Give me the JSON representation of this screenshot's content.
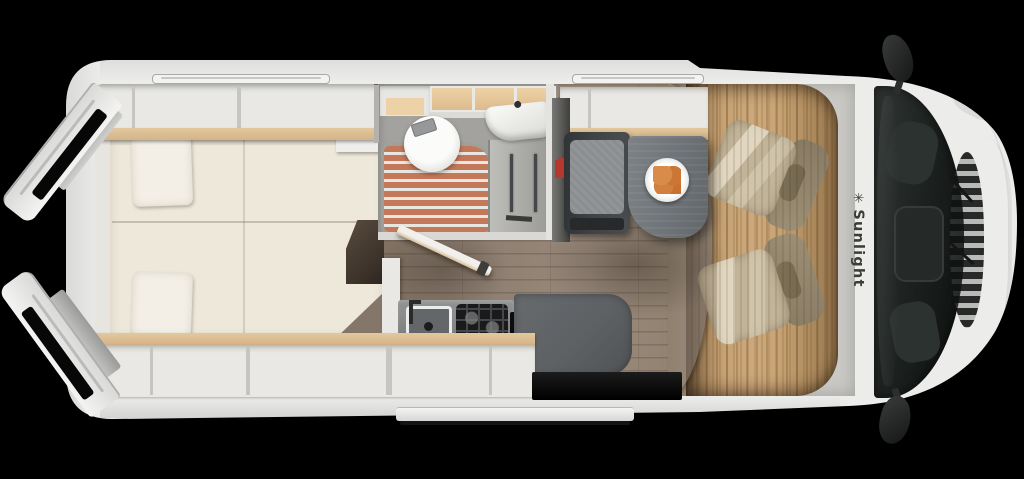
{
  "brand": {
    "name": "Sunlight",
    "logo_glyph": "✳"
  },
  "scene": {
    "description": "Top-down 3D cutaway floor plan render of a Sunlight camper van with open rear doors, rear bed, bathroom, kitchenette, dinette and swiveled cab seats",
    "background_color": "#000000"
  },
  "colors": {
    "bg": "#000000",
    "body-white": "#ececea",
    "interior-grey": "#c9c8c4",
    "bed-cream": "#eee8db",
    "pillow-cream": "#f3efe6",
    "wood-trim": "#e3c89e",
    "bath-cabinet-wood": "#ecd2a6",
    "shower-terracotta": "#c4785a",
    "living-floor-wood": "#8f8073",
    "cab-floor-wood": "#cca87a",
    "counter-grey": "#8a8c8b",
    "table-grey": "#70757a",
    "bench-dark": "#3f4244",
    "mat-grey": "#5d6164",
    "seat-beige": "#c2b499",
    "accent-red": "#b5382e",
    "windshield-dark": "#1a1e1d",
    "brand-text": "#3c3c3a",
    "food-orange": "#d2803f"
  }
}
